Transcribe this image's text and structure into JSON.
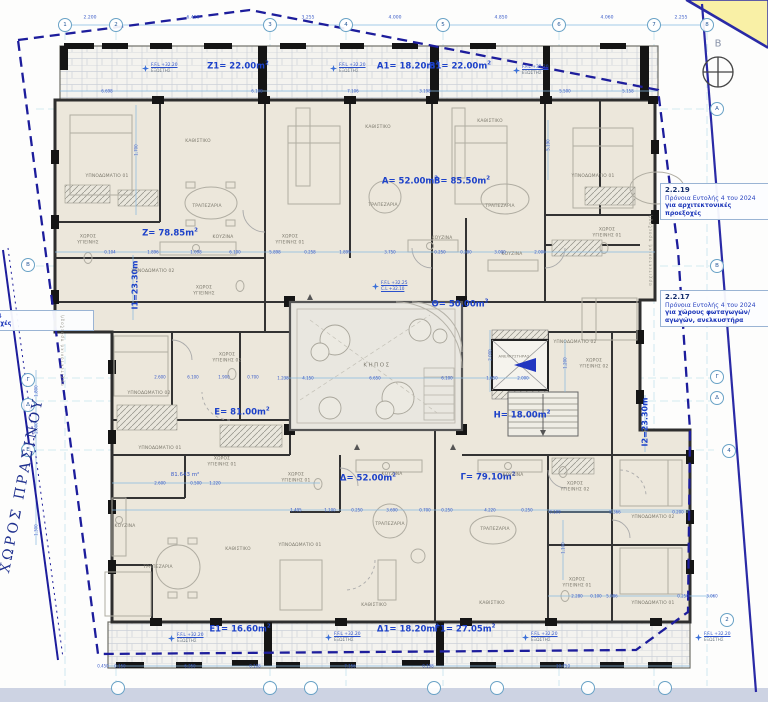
{
  "title": "Τυπικός όροφος - κάτοψη",
  "colors": {
    "area_text": "#1c41c9",
    "dim_text": "#3b5cc8",
    "room_text": "#7b786c",
    "boundary": "#1d1d9c",
    "grid_line": "#9ed2e4",
    "wall": "#333333",
    "floor_fill": "#ece7db",
    "corner_fill": "#f9f0a6",
    "bottom_strip": "#cdd3e3"
  },
  "north": {
    "label": "Β",
    "x": 718,
    "y": 44
  },
  "grid": {
    "top": [
      {
        "n": "1",
        "x": 65
      },
      {
        "n": "2",
        "x": 116
      },
      {
        "n": "3",
        "x": 270
      },
      {
        "n": "4",
        "x": 346
      },
      {
        "n": "5",
        "x": 443
      },
      {
        "n": "6",
        "x": 559
      },
      {
        "n": "7",
        "x": 654
      },
      {
        "n": "8",
        "x": 707
      }
    ],
    "top_dims": [
      {
        "t": "2.200",
        "x": 90
      },
      {
        "t": "6.450",
        "x": 193
      },
      {
        "t": "3.255",
        "x": 308
      },
      {
        "t": "4.000",
        "x": 395
      },
      {
        "t": "4.850",
        "x": 501
      },
      {
        "t": "4.060",
        "x": 607
      },
      {
        "t": "2.255",
        "x": 681
      }
    ],
    "bottom": [
      {
        "n": "",
        "x": 118
      },
      {
        "n": "",
        "x": 270
      },
      {
        "n": "",
        "x": 311
      },
      {
        "n": "",
        "x": 434
      },
      {
        "n": "",
        "x": 497
      },
      {
        "n": "",
        "x": 588
      },
      {
        "n": "",
        "x": 665
      }
    ],
    "right": [
      {
        "n": "Α",
        "y": 109
      },
      {
        "n": "Β",
        "y": 266
      },
      {
        "n": "Γ",
        "y": 377
      },
      {
        "n": "Δ",
        "y": 398
      }
    ],
    "left": [
      {
        "n": "Β",
        "y": 265
      },
      {
        "n": "Γ",
        "y": 380
      },
      {
        "n": "Δ",
        "y": 405
      },
      {
        "n": "Ε",
        "y": 450
      }
    ],
    "extra": [
      {
        "n": "4",
        "x": 729,
        "y": 451
      },
      {
        "n": "2",
        "x": 727,
        "y": 620
      }
    ]
  },
  "areas": [
    {
      "text": "Z1= 22.00m",
      "sup": "2",
      "x": 238,
      "y": 66
    },
    {
      "text": "A1= 18.20m",
      "sup": "2",
      "x": 408,
      "y": 66
    },
    {
      "text": "B1= 22.00m",
      "sup": "2",
      "x": 460,
      "y": 66
    },
    {
      "text": "Z= 78.85m",
      "sup": "2",
      "x": 170,
      "y": 233
    },
    {
      "text": "A= 52.00m",
      "sup": "2",
      "x": 410,
      "y": 181
    },
    {
      "text": "B= 85.50m",
      "sup": "2",
      "x": 462,
      "y": 181
    },
    {
      "text": "Θ= 50.00m",
      "sup": "2",
      "x": 460,
      "y": 304
    },
    {
      "text": "E= 81.00m",
      "sup": "2",
      "x": 242,
      "y": 412
    },
    {
      "text": "H= 18.00m",
      "sup": "2",
      "x": 522,
      "y": 415
    },
    {
      "text": "Δ= 52.00m",
      "sup": "2",
      "x": 368,
      "y": 478
    },
    {
      "text": "Γ= 79.10m",
      "sup": "2",
      "x": 488,
      "y": 477
    },
    {
      "text": "E1= 16.60m",
      "sup": "2",
      "x": 240,
      "y": 629
    },
    {
      "text": "Δ1= 18.20m",
      "sup": "2",
      "x": 408,
      "y": 629
    },
    {
      "text": "Γ1= 27.05m",
      "sup": "2",
      "x": 465,
      "y": 629
    },
    {
      "text": "Ι1=23.30m",
      "x": 135,
      "y": 285,
      "v": true
    },
    {
      "text": "Ι2=23.30m",
      "x": 645,
      "y": 422,
      "v": true
    }
  ],
  "levels": [
    {
      "l1": "F.F.L +32.20",
      "l2": "ΕΞΩΣΤΗΣ",
      "x": 147,
      "y": 70
    },
    {
      "l1": "F.F.L +32.20",
      "l2": "ΕΞΩΣΤΗΣ",
      "x": 335,
      "y": 70
    },
    {
      "l1": "F.F.L +32.20",
      "l2": "ΕΞΩΣΤΗΣ",
      "x": 518,
      "y": 72
    },
    {
      "l1": "F.F.L +32.25",
      "l2": "C.L +32.10",
      "x": 377,
      "y": 288,
      "blue2": true
    },
    {
      "l1": "F.F.L +32.20",
      "l2": "ΕΞΩΣΤΗΣ",
      "x": 173,
      "y": 640
    },
    {
      "l1": "F.F.L +32.20",
      "l2": "ΕΞΩΣΤΗΣ",
      "x": 330,
      "y": 639
    },
    {
      "l1": "F.F.L +32.20",
      "l2": "ΕΞΩΣΤΗΣ",
      "x": 527,
      "y": 639
    },
    {
      "l1": "F.F.L +32.20",
      "l2": "ΕΞΩΣΤΗΣ",
      "x": 700,
      "y": 639
    }
  ],
  "rooms": [
    {
      "t": "ΚΑΘΙΣΤΙΚΟ",
      "x": 198,
      "y": 142
    },
    {
      "t": "ΥΠΝΟΔΩΜΑΤΙΟ 01",
      "x": 107,
      "y": 177
    },
    {
      "t": "ΤΡΑΠΕΖΑΡΙΑ",
      "x": 207,
      "y": 207
    },
    {
      "t": "ΚΑΘΙΣΤΙΚΟ",
      "x": 378,
      "y": 128
    },
    {
      "t": "ΚΑΘΙΣΤΙΚΟ",
      "x": 490,
      "y": 122
    },
    {
      "t": "ΤΡΑΠΕΖΑΡΙΑ",
      "x": 383,
      "y": 206
    },
    {
      "t": "ΤΡΑΠΕΖΑΡΙΑ",
      "x": 500,
      "y": 207
    },
    {
      "t": "ΧΩΡΟΣ ΥΓΙΕΙΝΗΣ",
      "x": 88,
      "y": 240,
      "w": 34
    },
    {
      "t": "ΚΟΥΖΙΝΑ",
      "x": 223,
      "y": 238
    },
    {
      "t": "ΧΩΡΟΣ ΥΓΙΕΙΝΗΣ 01",
      "x": 290,
      "y": 240,
      "w": 34
    },
    {
      "t": "ΚΟΥΖΙΝΑ",
      "x": 442,
      "y": 239
    },
    {
      "t": "ΚΟΥΖΙΝΑ",
      "x": 512,
      "y": 255
    },
    {
      "t": "ΥΠΝΟΔΩΜΑΤΙΟ 01",
      "x": 593,
      "y": 177
    },
    {
      "t": "ΧΩΡΟΣ ΥΓΙΕΙΝΗΣ 01",
      "x": 607,
      "y": 233,
      "w": 34
    },
    {
      "t": "ΥΠΝΟΔΩΜΑΤΙΟ 02",
      "x": 153,
      "y": 272
    },
    {
      "t": "ΧΩΡΟΣ ΥΓΙΕΙΝΗΣ",
      "x": 204,
      "y": 291,
      "w": 34
    },
    {
      "t": "ΥΠΝΟΔΩΜΑΤΙΟ 02",
      "x": 575,
      "y": 343
    },
    {
      "t": "ΧΩΡΟΣ ΥΓΙΕΙΝΗΣ 02",
      "x": 594,
      "y": 364,
      "w": 34
    },
    {
      "t": "ΧΩΡΟΣ ΥΓΙΕΙΝΗΣ 02",
      "x": 227,
      "y": 358,
      "w": 34
    },
    {
      "t": "ΥΠΝΟΔΩΜΑΤΙΟ 02",
      "x": 149,
      "y": 394
    },
    {
      "t": "ΥΠΝΟΔΩΜΑΤΙΟ 01",
      "x": 160,
      "y": 449
    },
    {
      "t": "ΧΩΡΟΣ ΥΓΙΕΙΝΗΣ 01",
      "x": 222,
      "y": 462,
      "w": 34
    },
    {
      "t": "ΧΩΡΟΣ ΥΓΙΕΙΝΗΣ 01",
      "x": 296,
      "y": 478,
      "w": 34
    },
    {
      "t": "ΚΟΥΖΙΝΑ",
      "x": 392,
      "y": 475
    },
    {
      "t": "ΚΟΥΖΙΝΑ",
      "x": 513,
      "y": 476
    },
    {
      "t": "ΚΟΥΖΙΝΑ",
      "x": 125,
      "y": 527
    },
    {
      "t": "ΚΑΘΙΣΤΙΚΟ",
      "x": 238,
      "y": 550
    },
    {
      "t": "ΤΡΑΠΕΖΑΡΙΑ",
      "x": 158,
      "y": 568
    },
    {
      "t": "ΥΠΝΟΔΩΜΑΤΙΟ 01",
      "x": 300,
      "y": 546
    },
    {
      "t": "ΤΡΑΠΕΖΑΡΙΑ",
      "x": 390,
      "y": 525
    },
    {
      "t": "ΤΡΑΠΕΖΑΡΙΑ",
      "x": 495,
      "y": 530
    },
    {
      "t": "ΚΑΘΙΣΤΙΚΟ",
      "x": 374,
      "y": 606
    },
    {
      "t": "ΚΑΘΙΣΤΙΚΟ",
      "x": 492,
      "y": 604
    },
    {
      "t": "ΧΩΡΟΣ ΥΓΙΕΙΝΗΣ 02",
      "x": 575,
      "y": 487,
      "w": 34
    },
    {
      "t": "ΥΠΝΟΔΩΜΑΤΙΟ 02",
      "x": 653,
      "y": 518
    },
    {
      "t": "ΧΩΡΟΣ ΥΓΙΕΙΝΗΣ 01",
      "x": 577,
      "y": 583,
      "w": 34
    },
    {
      "t": "ΥΠΝΟΔΩΜΑΤΙΟ 01",
      "x": 653,
      "y": 604
    },
    {
      "t": "ΑΝΕΛΚΥΣΤΗΡΑΣ",
      "x": 514,
      "y": 357,
      "s": 3.6
    },
    {
      "t": "ΚΗΠΟΣ",
      "x": 377,
      "y": 366,
      "s": 5.5,
      "sp": 1.5
    }
  ],
  "dims": [
    {
      "t": "6.698",
      "x": 107,
      "y": 91
    },
    {
      "t": "6.108",
      "x": 257,
      "y": 91
    },
    {
      "t": "7.106",
      "x": 353,
      "y": 91
    },
    {
      "t": "3.198",
      "x": 425,
      "y": 91
    },
    {
      "t": "5.500",
      "x": 565,
      "y": 91
    },
    {
      "t": "5.158",
      "x": 628,
      "y": 91
    },
    {
      "t": "0.104",
      "x": 110,
      "y": 252
    },
    {
      "t": "1.896",
      "x": 153,
      "y": 252
    },
    {
      "t": "1.098",
      "x": 196,
      "y": 252
    },
    {
      "t": "6.100",
      "x": 235,
      "y": 252
    },
    {
      "t": "5.898",
      "x": 275,
      "y": 252
    },
    {
      "t": "0.258",
      "x": 310,
      "y": 252
    },
    {
      "t": "1.899",
      "x": 345,
      "y": 252
    },
    {
      "t": "3.750",
      "x": 390,
      "y": 252
    },
    {
      "t": "0.250",
      "x": 440,
      "y": 252
    },
    {
      "t": "0.280",
      "x": 466,
      "y": 252
    },
    {
      "t": "3.000",
      "x": 500,
      "y": 252
    },
    {
      "t": "2.000",
      "x": 540,
      "y": 252
    },
    {
      "t": "2.600",
      "x": 160,
      "y": 377
    },
    {
      "t": "6.100",
      "x": 193,
      "y": 377
    },
    {
      "t": "1.900",
      "x": 224,
      "y": 377
    },
    {
      "t": "0.700",
      "x": 253,
      "y": 377
    },
    {
      "t": "1.238",
      "x": 283,
      "y": 378
    },
    {
      "t": "4.150",
      "x": 308,
      "y": 378
    },
    {
      "t": "6.650",
      "x": 375,
      "y": 378
    },
    {
      "t": "6.100",
      "x": 447,
      "y": 378
    },
    {
      "t": "1.650",
      "x": 492,
      "y": 378
    },
    {
      "t": "2.000",
      "x": 523,
      "y": 378
    },
    {
      "t": "1.495",
      "x": 296,
      "y": 510
    },
    {
      "t": "1.100",
      "x": 330,
      "y": 510
    },
    {
      "t": "0.250",
      "x": 357,
      "y": 510
    },
    {
      "t": "3.690",
      "x": 392,
      "y": 510
    },
    {
      "t": "0.700",
      "x": 425,
      "y": 510
    },
    {
      "t": "0.250",
      "x": 447,
      "y": 510
    },
    {
      "t": "4.220",
      "x": 490,
      "y": 510
    },
    {
      "t": "0.250",
      "x": 527,
      "y": 510
    },
    {
      "t": "2.600",
      "x": 160,
      "y": 483
    },
    {
      "t": "0.500",
      "x": 196,
      "y": 483
    },
    {
      "t": "1.220",
      "x": 215,
      "y": 483
    },
    {
      "t": "81.643 m²",
      "x": 185,
      "y": 475,
      "s": 5.5
    },
    {
      "t": "0.100",
      "x": 555,
      "y": 512
    },
    {
      "t": "5.366",
      "x": 615,
      "y": 512
    },
    {
      "t": "0.200",
      "x": 678,
      "y": 512
    },
    {
      "t": "2.280",
      "x": 577,
      "y": 596
    },
    {
      "t": "0.100",
      "x": 596,
      "y": 596
    },
    {
      "t": "5.086",
      "x": 612,
      "y": 596
    },
    {
      "t": "0.250",
      "x": 683,
      "y": 596
    },
    {
      "t": "3.060",
      "x": 712,
      "y": 596
    },
    {
      "t": "0.450",
      "x": 103,
      "y": 666
    },
    {
      "t": "0.150",
      "x": 120,
      "y": 666
    },
    {
      "t": "6.350",
      "x": 190,
      "y": 666
    },
    {
      "t": "0.108",
      "x": 255,
      "y": 666
    },
    {
      "t": "7.156",
      "x": 350,
      "y": 666
    },
    {
      "t": "0.198",
      "x": 428,
      "y": 666
    },
    {
      "t": "10.750",
      "x": 563,
      "y": 666
    },
    {
      "t": "5.190",
      "x": 548,
      "y": 145,
      "v": true
    },
    {
      "t": "1.700",
      "x": 136,
      "y": 150,
      "v": true
    },
    {
      "t": "2.000",
      "x": 490,
      "y": 355,
      "v": true
    },
    {
      "t": "1.200",
      "x": 565,
      "y": 363,
      "v": true
    },
    {
      "t": "1.100",
      "x": 563,
      "y": 548,
      "v": true
    },
    {
      "t": "1.800",
      "x": 36,
      "y": 391,
      "v": true
    },
    {
      "t": "2.600",
      "x": 36,
      "y": 428,
      "v": true
    },
    {
      "t": "1.300",
      "x": 36,
      "y": 530,
      "v": true
    }
  ],
  "notes": [
    {
      "id": "2.2.19",
      "lines": [
        "Πρόνοια Εντολής 4 του 2024",
        "για αρχιτεκτονικές προεξοχές"
      ],
      "x": 660,
      "y": 183,
      "w": 104
    },
    {
      "id": "2.2.17",
      "lines": [
        "Πρόνοια Εντολής 4 του 2024",
        "για χώρους φωταγωγών/",
        "αγωγών, ανελκυστήρα"
      ],
      "x": 660,
      "y": 290,
      "w": 104
    },
    {
      "id": "",
      "lines": [
        "Εντολής 4 του 2024",
        "εκτονικές προεξοχές"
      ],
      "x": -66,
      "y": 310,
      "w": 150
    }
  ],
  "vertical_labels": [
    {
      "t": "ΧΩΡΟΣ ΠΡΑΣΙΝΟΥ",
      "x": 22,
      "y": 485,
      "big": true
    },
    {
      "t": "αρχιτεκτονική προεξοχή",
      "x": 62,
      "y": 350,
      "tiny": true
    },
    {
      "t": "αρχιτεκτονική προεξοχή",
      "x": 650,
      "y": 250,
      "tiny": true
    }
  ]
}
